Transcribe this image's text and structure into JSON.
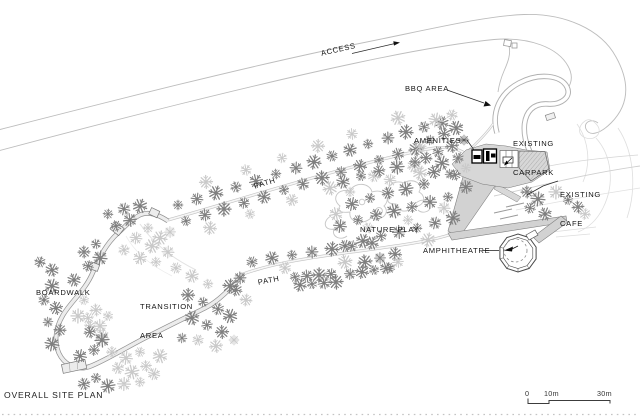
{
  "title": "OVERALL SITE PLAN",
  "labels": {
    "access": "ACCESS",
    "bbq_area": "BBQ AREA",
    "amenities": "AMENITIES",
    "existing_carpark": [
      "EXISTING",
      "CARPARK"
    ],
    "existing_cafe": [
      "EXISTING",
      "CAFE"
    ],
    "nature_play": "NATURE PLAY",
    "amphitheatre": "AMPHITHEATRE",
    "path_upper": "PATH",
    "path_lower": "PATH",
    "transition_area": [
      "TRANSITION",
      "AREA"
    ],
    "boardwalk": "BOARDWALK"
  },
  "scale_bar": {
    "start": "0",
    "mid": "10m",
    "end": "30m"
  },
  "colors": {
    "paper": "#ffffff",
    "road_line": "#bdbdbd",
    "path_edge": "#c2c2c2",
    "boardwalk_edge": "#909090",
    "boardwalk_fill": "#ececec",
    "ramp_fill": "#d2d2d2",
    "carpark_fill": "#d7d7d7",
    "building_ink": "#000000",
    "label_ink": "#161616",
    "tree_dark": "#7f7f7f",
    "tree_light": "#c9c9c9",
    "contour": "#dedede"
  },
  "trees": [
    [
      178,
      205,
      0
    ],
    [
      197,
      199,
      0
    ],
    [
      216,
      193,
      0
    ],
    [
      236,
      187,
      0
    ],
    [
      256,
      181,
      0
    ],
    [
      276,
      174,
      0
    ],
    [
      296,
      168,
      0
    ],
    [
      314,
      162,
      0
    ],
    [
      332,
      156,
      0
    ],
    [
      350,
      150,
      0
    ],
    [
      368,
      144,
      0
    ],
    [
      388,
      138,
      0
    ],
    [
      406,
      132,
      0
    ],
    [
      424,
      127,
      0
    ],
    [
      442,
      123,
      0
    ],
    [
      186,
      221,
      0
    ],
    [
      205,
      215,
      0
    ],
    [
      224,
      209,
      0
    ],
    [
      244,
      203,
      0
    ],
    [
      264,
      197,
      0
    ],
    [
      284,
      190,
      0
    ],
    [
      303,
      184,
      0
    ],
    [
      322,
      178,
      0
    ],
    [
      341,
      172,
      0
    ],
    [
      360,
      166,
      0
    ],
    [
      379,
      160,
      0
    ],
    [
      398,
      154,
      0
    ],
    [
      416,
      149,
      0
    ],
    [
      170,
      232,
      1
    ],
    [
      210,
      228,
      1
    ],
    [
      250,
      214,
      1
    ],
    [
      292,
      200,
      1
    ],
    [
      330,
      188,
      1
    ],
    [
      352,
      134,
      1
    ],
    [
      318,
      146,
      1
    ],
    [
      282,
      158,
      1
    ],
    [
      374,
      176,
      1
    ],
    [
      398,
      118,
      1
    ],
    [
      246,
      170,
      1
    ],
    [
      206,
      182,
      1
    ],
    [
      430,
      140,
      0
    ],
    [
      444,
      134,
      0
    ],
    [
      456,
      128,
      0
    ],
    [
      438,
      152,
      0
    ],
    [
      452,
      146,
      0
    ],
    [
      464,
      140,
      0
    ],
    [
      426,
      158,
      0
    ],
    [
      442,
      163,
      0
    ],
    [
      458,
      158,
      0
    ],
    [
      434,
      172,
      0
    ],
    [
      450,
      174,
      0
    ],
    [
      420,
      146,
      1
    ],
    [
      436,
      120,
      1
    ],
    [
      452,
      115,
      1
    ],
    [
      414,
      166,
      1
    ],
    [
      466,
      168,
      1
    ],
    [
      527,
      192,
      0
    ],
    [
      538,
      199,
      0
    ],
    [
      530,
      208,
      0
    ],
    [
      545,
      214,
      0
    ],
    [
      568,
      200,
      0
    ],
    [
      578,
      207,
      0
    ],
    [
      556,
      192,
      1
    ],
    [
      585,
      214,
      1
    ],
    [
      343,
      182,
      0
    ],
    [
      361,
      176,
      0
    ],
    [
      379,
      171,
      0
    ],
    [
      397,
      167,
      0
    ],
    [
      415,
      162,
      0
    ],
    [
      352,
      204,
      0
    ],
    [
      370,
      198,
      0
    ],
    [
      388,
      193,
      0
    ],
    [
      406,
      189,
      0
    ],
    [
      424,
      184,
      0
    ],
    [
      340,
      226,
      0
    ],
    [
      358,
      220,
      0
    ],
    [
      376,
      215,
      0
    ],
    [
      394,
      211,
      0
    ],
    [
      412,
      207,
      0
    ],
    [
      430,
      202,
      0
    ],
    [
      448,
      197,
      0
    ],
    [
      345,
      246,
      0
    ],
    [
      363,
      241,
      0
    ],
    [
      381,
      236,
      0
    ],
    [
      399,
      232,
      0
    ],
    [
      417,
      228,
      0
    ],
    [
      435,
      223,
      0
    ],
    [
      453,
      218,
      0
    ],
    [
      455,
      175,
      0
    ],
    [
      466,
      187,
      0
    ],
    [
      350,
      192,
      1
    ],
    [
      390,
      180,
      1
    ],
    [
      420,
      173,
      1
    ],
    [
      368,
      228,
      1
    ],
    [
      336,
      214,
      1
    ],
    [
      408,
      220,
      1
    ],
    [
      444,
      208,
      1
    ],
    [
      428,
      240,
      1
    ],
    [
      252,
      262,
      0
    ],
    [
      272,
      258,
      0
    ],
    [
      292,
      255,
      0
    ],
    [
      312,
      252,
      0
    ],
    [
      332,
      249,
      0
    ],
    [
      352,
      246,
      0
    ],
    [
      372,
      243,
      0
    ],
    [
      295,
      277,
      0
    ],
    [
      307,
      276,
      0
    ],
    [
      319,
      275,
      0
    ],
    [
      331,
      274,
      0
    ],
    [
      300,
      285,
      0
    ],
    [
      312,
      284,
      0
    ],
    [
      324,
      283,
      0
    ],
    [
      336,
      282,
      0
    ],
    [
      350,
      274,
      0
    ],
    [
      362,
      272,
      0
    ],
    [
      374,
      270,
      0
    ],
    [
      386,
      268,
      0
    ],
    [
      365,
      262,
      0
    ],
    [
      380,
      258,
      0
    ],
    [
      395,
      254,
      0
    ],
    [
      390,
      268,
      0
    ],
    [
      285,
      268,
      1
    ],
    [
      345,
      262,
      1
    ],
    [
      398,
      262,
      1
    ],
    [
      188,
      295,
      0
    ],
    [
      203,
      302,
      0
    ],
    [
      218,
      309,
      0
    ],
    [
      192,
      318,
      0
    ],
    [
      207,
      325,
      0
    ],
    [
      222,
      332,
      0
    ],
    [
      182,
      338,
      0
    ],
    [
      236,
      290,
      0
    ],
    [
      230,
      316,
      0
    ],
    [
      198,
      340,
      1
    ],
    [
      216,
      346,
      1
    ],
    [
      234,
      340,
      1
    ],
    [
      246,
      300,
      1
    ],
    [
      52,
      286,
      0
    ],
    [
      44,
      300,
      0
    ],
    [
      56,
      308,
      0
    ],
    [
      48,
      322,
      0
    ],
    [
      60,
      330,
      0
    ],
    [
      52,
      344,
      0
    ],
    [
      40,
      262,
      0
    ],
    [
      52,
      270,
      0
    ],
    [
      96,
      244,
      0
    ],
    [
      84,
      252,
      0
    ],
    [
      100,
      258,
      0
    ],
    [
      88,
      266,
      0
    ],
    [
      74,
      280,
      0
    ],
    [
      84,
      300,
      1
    ],
    [
      96,
      310,
      1
    ],
    [
      78,
      316,
      1
    ],
    [
      90,
      326,
      1
    ],
    [
      102,
      336,
      1
    ],
    [
      108,
      316,
      1
    ],
    [
      90,
      332,
      0
    ],
    [
      102,
      340,
      0
    ],
    [
      94,
      350,
      0
    ],
    [
      80,
      356,
      0
    ],
    [
      96,
      378,
      0
    ],
    [
      84,
      384,
      0
    ],
    [
      108,
      386,
      0
    ],
    [
      112,
      352,
      1
    ],
    [
      126,
      358,
      1
    ],
    [
      140,
      352,
      1
    ],
    [
      118,
      368,
      1
    ],
    [
      132,
      372,
      1
    ],
    [
      146,
      366,
      1
    ],
    [
      124,
      384,
      1
    ],
    [
      140,
      382,
      1
    ],
    [
      154,
      374,
      1
    ],
    [
      160,
      356,
      1
    ],
    [
      88,
      318,
      1
    ],
    [
      100,
      326,
      1
    ],
    [
      108,
      214,
      0
    ],
    [
      124,
      209,
      0
    ],
    [
      140,
      206,
      0
    ],
    [
      116,
      226,
      0
    ],
    [
      130,
      220,
      0
    ],
    [
      148,
      228,
      1
    ],
    [
      136,
      238,
      1
    ],
    [
      152,
      246,
      1
    ],
    [
      124,
      250,
      1
    ],
    [
      140,
      258,
      1
    ],
    [
      156,
      262,
      1
    ],
    [
      168,
      252,
      1
    ],
    [
      160,
      238,
      1
    ],
    [
      176,
      268,
      1
    ],
    [
      192,
      276,
      1
    ],
    [
      208,
      284,
      1
    ],
    [
      240,
      278,
      0
    ],
    [
      230,
      286,
      0
    ]
  ]
}
